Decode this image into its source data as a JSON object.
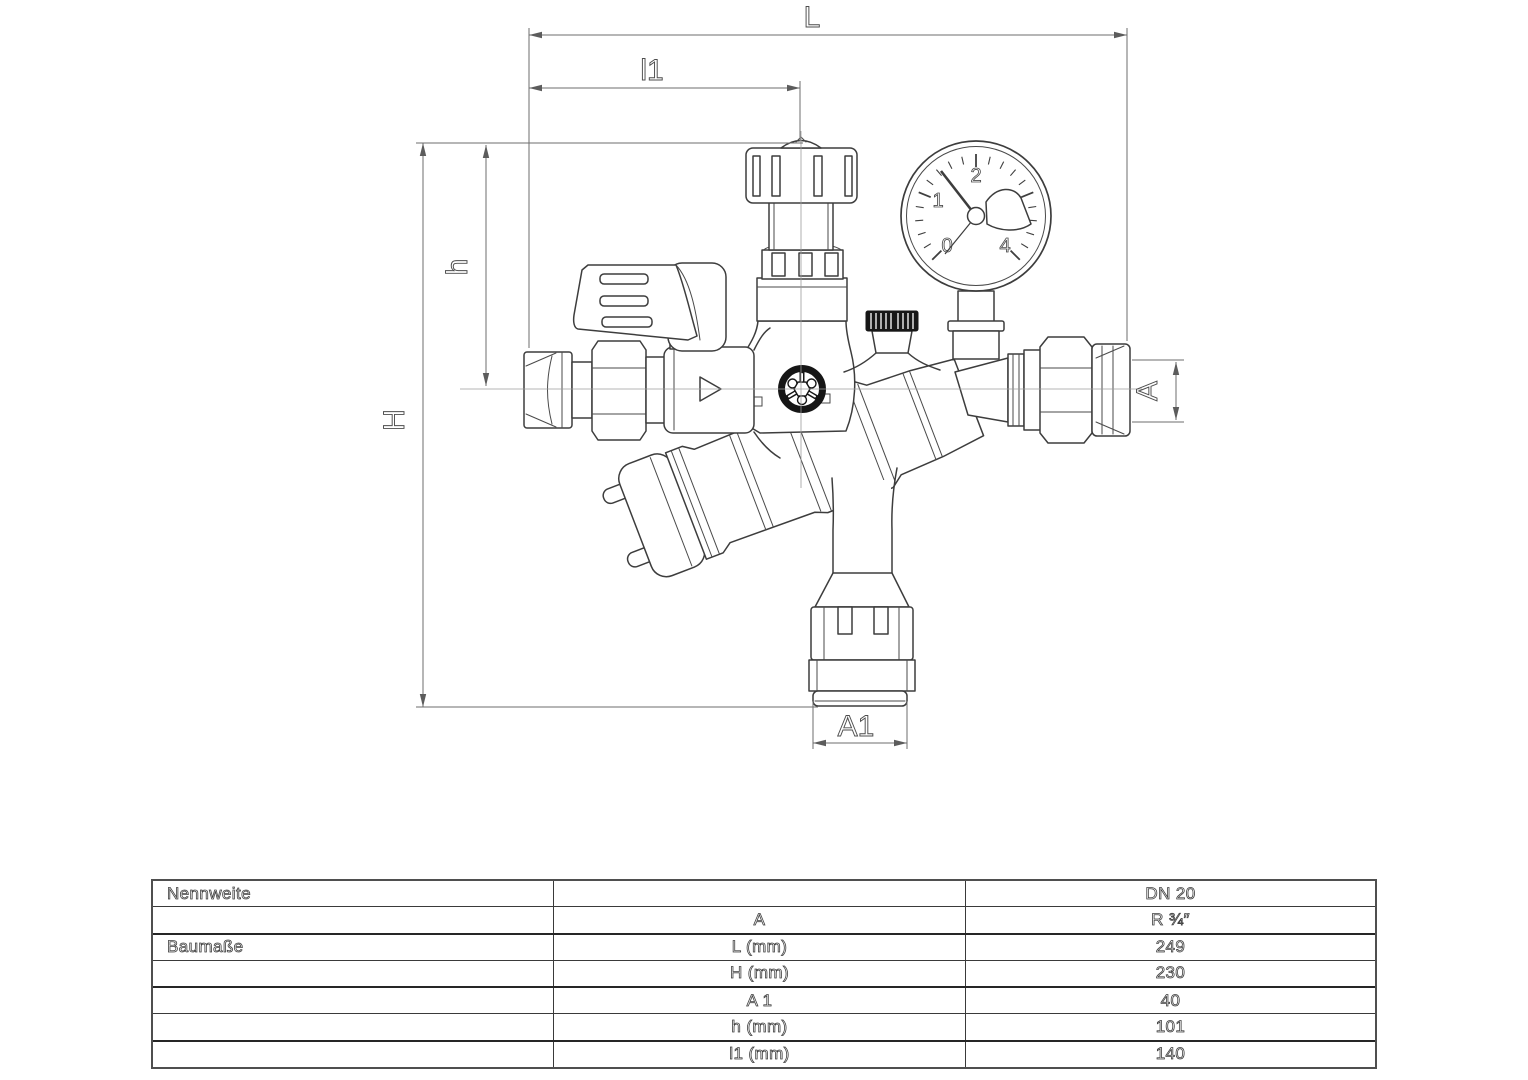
{
  "drawing": {
    "dimensions": {
      "L": "L",
      "l1": "l1",
      "H": "H",
      "h": "h",
      "A": "A",
      "A1": "A1"
    },
    "gauge": {
      "labels": [
        "0",
        "1",
        "2",
        "3",
        "4"
      ]
    },
    "colors": {
      "line": "#3d3d3d",
      "dimension": "#6e6e6e",
      "black_parts": "#161616",
      "background": "#ffffff"
    }
  },
  "table": {
    "rows": [
      {
        "c1": "Nennweite",
        "c2": "",
        "c3": "DN 20"
      },
      {
        "c1": "",
        "c2": "A",
        "c3": "R ¾″"
      },
      {
        "c1": "Baumaße",
        "c2": "L (mm)",
        "c3": "249"
      },
      {
        "c1": "",
        "c2": "H (mm)",
        "c3": "230"
      },
      {
        "c1": "",
        "c2": "A 1",
        "c3": "40"
      },
      {
        "c1": "",
        "c2": "h (mm)",
        "c3": "101"
      },
      {
        "c1": "",
        "c2": "l1 (mm)",
        "c3": "140"
      }
    ]
  }
}
